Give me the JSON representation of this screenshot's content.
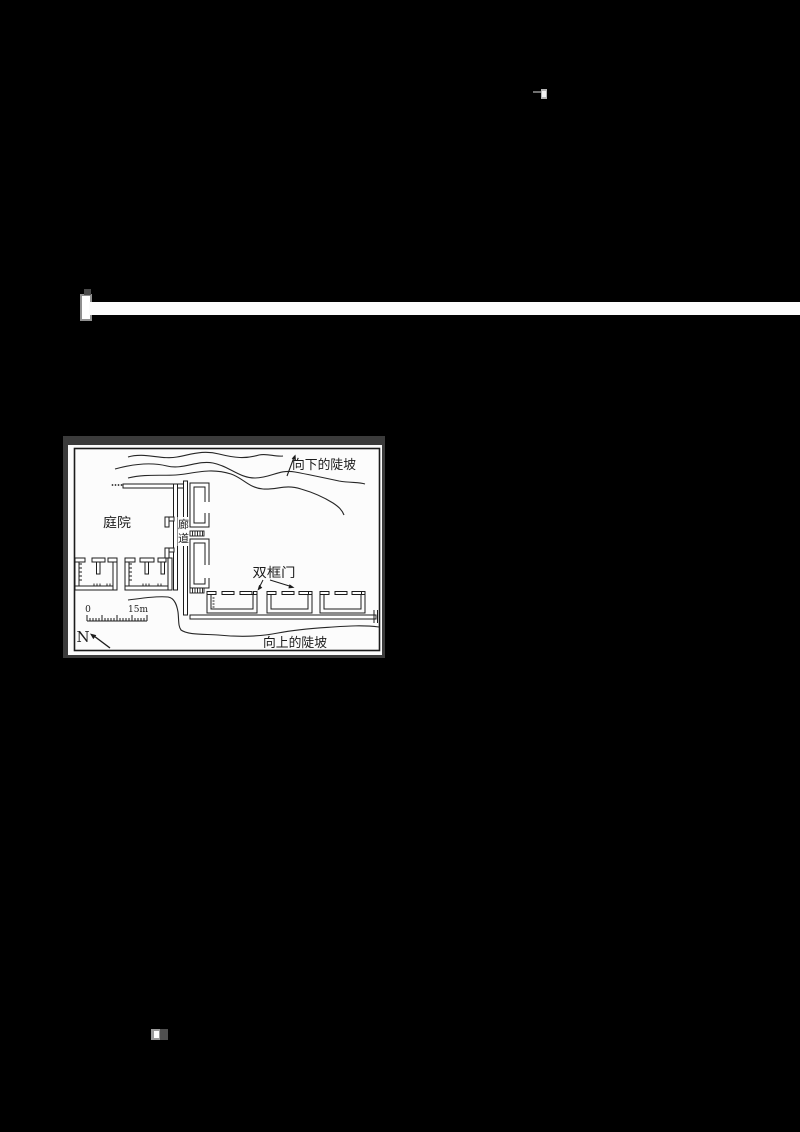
{
  "page": {
    "background": "#000000"
  },
  "figure": {
    "colors": {
      "paper": "#fcfcfc",
      "ink": "#1c1c1c",
      "frame": "#3b3b3b"
    },
    "labels": {
      "slope_top": "向下的陡坡",
      "courtyard": "庭院",
      "corridor_char1": "廊",
      "corridor_char2": "道",
      "double_door": "双框门",
      "slope_bottom": "向上的陡坡",
      "scale_start": "0",
      "scale_end": "15m",
      "north": "N"
    }
  }
}
